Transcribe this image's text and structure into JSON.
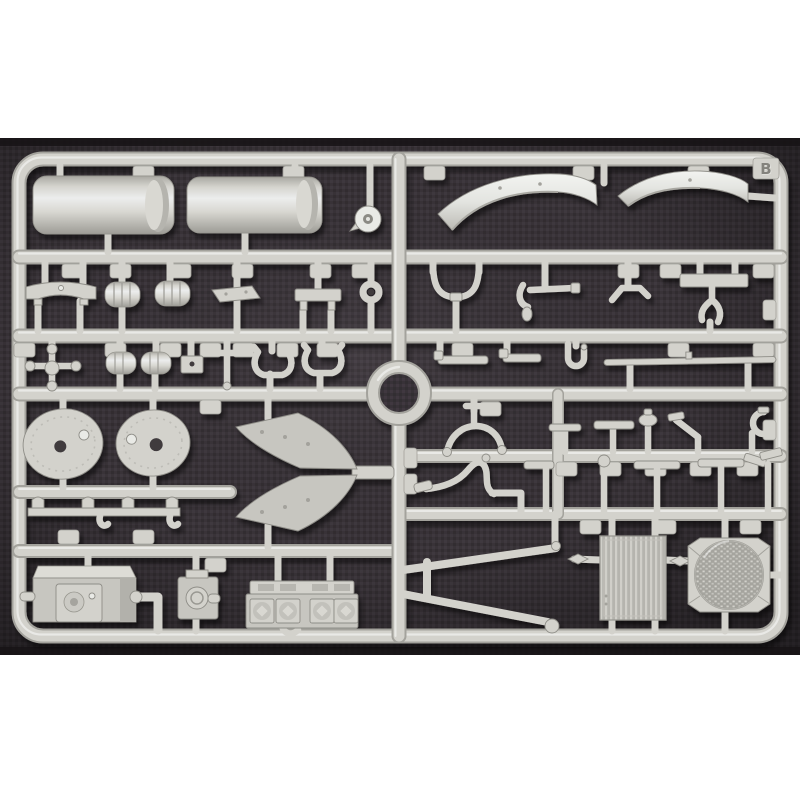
{
  "page": {
    "background": "#ffffff"
  },
  "photo": {
    "kind": "photograph of an injection-molded plastic model kit sprue on dark fabric",
    "sprue_letter": "B",
    "colors": {
      "page_bg": "#ffffff",
      "plastic": "#d3d2cc",
      "plastic_highlight": "#eceded",
      "plastic_shadow": "#a3a29c",
      "plastic_edge": "#8e8d87",
      "plastic_bright": "#e9eae6",
      "plastic_flat": "#c7c6c0",
      "fabric": "#393338",
      "fabric_weave": "#4b454c",
      "fabric_dark": "#161315",
      "letter_color": "#84837d"
    },
    "parts": [
      {
        "label": "fuel tank half",
        "count": 2
      },
      {
        "label": "idler pulley",
        "count": 1
      },
      {
        "label": "front fender",
        "count": 2
      },
      {
        "label": "curved mounting bracket",
        "count": 1
      },
      {
        "label": "exhaust muffler",
        "count": 4
      },
      {
        "label": "armor plate",
        "count": 1
      },
      {
        "label": "mounting bracket",
        "count": 2
      },
      {
        "label": "towing eye ring",
        "count": 1
      },
      {
        "label": "handlebar clamp",
        "count": 1
      },
      {
        "label": "hook rod",
        "count": 1
      },
      {
        "label": "bent linkage rod",
        "count": 1
      },
      {
        "label": "fork bracket",
        "count": 1
      },
      {
        "label": "control cross shaft",
        "count": 1
      },
      {
        "label": "junction block",
        "count": 1
      },
      {
        "label": "tow shackle",
        "count": 2
      },
      {
        "label": "step pedal",
        "count": 2
      },
      {
        "label": "U-hook",
        "count": 1
      },
      {
        "label": "tie rod strip",
        "count": 1
      },
      {
        "label": "oval hatch cover",
        "count": 2
      },
      {
        "label": "mudguard chevron half",
        "count": 2
      },
      {
        "label": "tow hook rail",
        "count": 1
      },
      {
        "label": "engine block",
        "count": 1
      },
      {
        "label": "elbow pipe",
        "count": 1
      },
      {
        "label": "fuel pump housing",
        "count": 1
      },
      {
        "label": "cylinder head",
        "count": 1
      },
      {
        "label": "tow bar A-frame",
        "count": 1
      },
      {
        "label": "arc clamp",
        "count": 1
      },
      {
        "label": "swan-neck pipe",
        "count": 1
      },
      {
        "label": "periscope handle",
        "count": 10
      },
      {
        "label": "radiator core",
        "count": 1
      },
      {
        "label": "fan shroud grille",
        "count": 1
      },
      {
        "label": "circular runner ring",
        "count": 1
      },
      {
        "label": "part number tag",
        "count": 34
      }
    ]
  }
}
